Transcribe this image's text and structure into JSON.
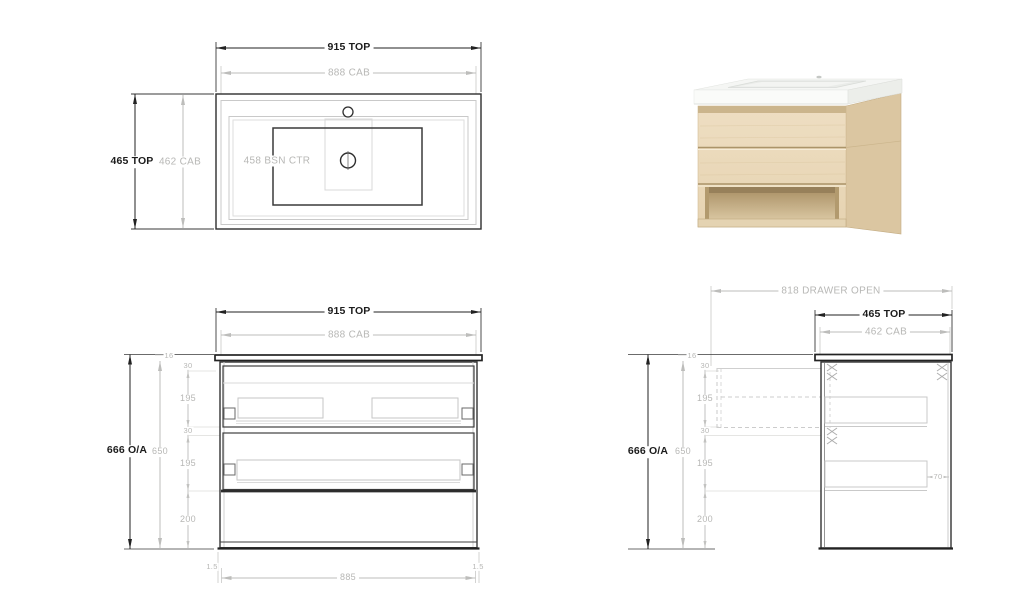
{
  "sheet": {
    "background": "#ffffff"
  },
  "palette": {
    "dim_dark": "#222222",
    "dim_gray": "#bdbdbb",
    "line_dark": "#2e2e2e",
    "line_gray": "#c9c9c9",
    "oak_front": "#ebdabc",
    "oak_side": "#dbc6a1",
    "oak_strip": "#cbb58c",
    "shelf_shadow": "#97805a",
    "top_white": "#f5f6f4"
  },
  "views": {
    "plan": {
      "labels": {
        "top_width": "915 TOP",
        "cab_width": "888 CAB",
        "top_depth": "465 TOP",
        "cab_depth": "462 CAB",
        "basin_centre": "458 BSN CTR"
      }
    },
    "front": {
      "labels": {
        "top_width": "915 TOP",
        "cab_width": "888 CAB",
        "overall_height": "666 O/A",
        "cab_height": "650",
        "top_thickness": "16",
        "gap_top": "30",
        "drawer_one": "195",
        "gap_mid": "30",
        "drawer_two": "195",
        "shelf_height": "200",
        "clearance_left": "1.5",
        "internal_width": "885",
        "clearance_right": "1.5"
      }
    },
    "side": {
      "labels": {
        "drawer_open": "818 DRAWER OPEN",
        "top_depth": "465 TOP",
        "cab_depth": "462 CAB",
        "overall_height": "666 O/A",
        "cab_height": "650",
        "top_thickness": "16",
        "gap_top": "30",
        "drawer_one": "195",
        "gap_mid": "30",
        "drawer_two": "195",
        "shelf_height": "200",
        "rear_clearance": "70"
      }
    },
    "render": {
      "alt": "wall-hung oak vanity with white basin top, two drawers and open shelf"
    }
  }
}
